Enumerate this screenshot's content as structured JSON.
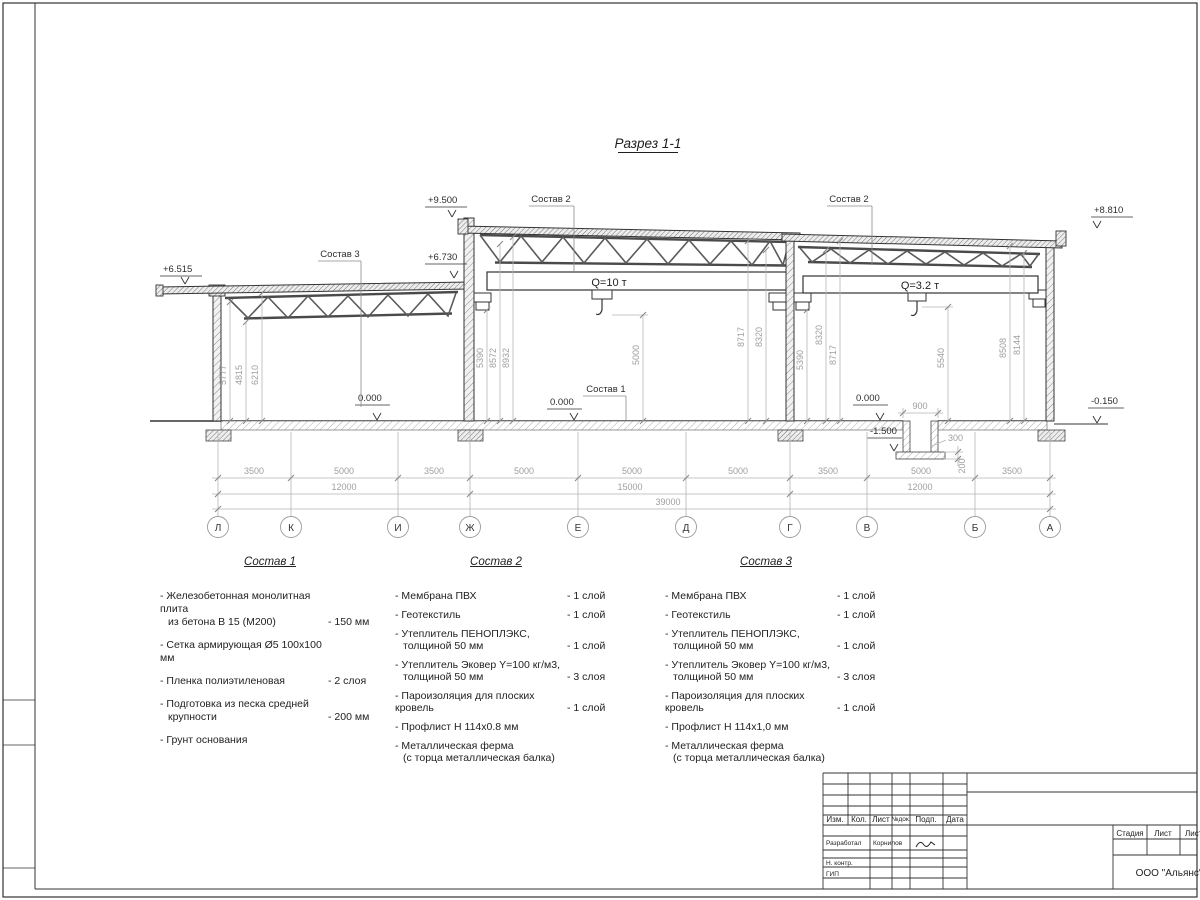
{
  "drawing": {
    "title": "Разрез 1-1",
    "levels": {
      "left_eave": "+6.515",
      "left_high": "+6.730",
      "mid_top": "+9.500",
      "right_top": "+8.810",
      "zero_left": "0.000",
      "zero_mid": "0.000",
      "zero_pit": "0.000",
      "pit_bottom": "-1.500",
      "grade_right": "-0.150"
    },
    "callouts": {
      "sostav1": "Состав 1",
      "sostav2_mid": "Состав 2",
      "sostav2_right": "Состав 2",
      "sostav3": "Состав 3"
    },
    "cranes": {
      "mid": "Q=10 т",
      "right": "Q=3.2 т"
    },
    "vdims": [
      "5777",
      "4815",
      "6210",
      "5390",
      "8572",
      "8932",
      "5000",
      "8717",
      "8320",
      "5390",
      "8320",
      "8717",
      "5540",
      "8508",
      "8144"
    ],
    "pit": {
      "width": "900",
      "wall": "300",
      "base": "200"
    },
    "dims1": [
      "3500",
      "5000",
      "3500",
      "5000",
      "5000",
      "5000",
      "3500",
      "5000",
      "3500"
    ],
    "dims2": [
      "12000",
      "15000",
      "12000"
    ],
    "total": "39000",
    "axes": [
      "Л",
      "К",
      "И",
      "Ж",
      "Е",
      "Д",
      "Г",
      "В",
      "Б",
      "А"
    ]
  },
  "legends": [
    {
      "title": "Состав 1",
      "items": [
        {
          "l1": "- Железобетонная  монолитная плита",
          "l2": "из бетона В 15 (М200)",
          "qty": "- 150 мм"
        },
        {
          "l1": "- Сетка армирующая Ø5 100х100 мм",
          "l2": "",
          "qty": ""
        },
        {
          "l1": "- Пленка полиэтиленовая",
          "l2": "",
          "qty": "-  2 слоя"
        },
        {
          "l1": "- Подготовка из песка средней",
          "l2": "крупности",
          "qty": "- 200 мм"
        },
        {
          "l1": "- Грунт основания",
          "l2": "",
          "qty": ""
        }
      ]
    },
    {
      "title": "Состав 2",
      "items": [
        {
          "l1": "- Мембрана ПВХ",
          "l2": "",
          "qty": "- 1 слой"
        },
        {
          "l1": "- Геотекстиль",
          "l2": "",
          "qty": "- 1 слой"
        },
        {
          "l1": "- Утеплитель ПЕНОПЛЭКС,",
          "l2": "толщиной 50 мм",
          "qty": "- 1 слой"
        },
        {
          "l1": "- Утеплитель Эковер Y=100 кг/м3,",
          "l2": "толщиной 50 мм",
          "qty": "- 3 слоя"
        },
        {
          "l1": "- Пароизоляция для плоских кровель",
          "l2": "",
          "qty": "- 1 слой"
        },
        {
          "l1": "- Профлист Н 114х0.8 мм",
          "l2": "",
          "qty": ""
        },
        {
          "l1": "- Металлическая ферма",
          "l2": "(с торца металлическая балка)",
          "qty": ""
        }
      ]
    },
    {
      "title": "Состав 3",
      "items": [
        {
          "l1": "- Мембрана ПВХ",
          "l2": "",
          "qty": "- 1 слой"
        },
        {
          "l1": "- Геотекстиль",
          "l2": "",
          "qty": "- 1 слой"
        },
        {
          "l1": "- Утеплитель ПЕНОПЛЭКС,",
          "l2": "толщиной 50 мм",
          "qty": "- 1 слой"
        },
        {
          "l1": "- Утеплитель Эковер Y=100 кг/м3,",
          "l2": "толщиной 50 мм",
          "qty": "- 3 слоя"
        },
        {
          "l1": "- Пароизоляция для плоских кровель",
          "l2": "",
          "qty": "- 1 слой"
        },
        {
          "l1": "- Профлист Н 114х1,0 мм",
          "l2": "",
          "qty": ""
        },
        {
          "l1": "- Металлическая ферма",
          "l2": "(с торца металлическая балка)",
          "qty": ""
        }
      ]
    }
  ],
  "titleblock": {
    "header": [
      "Изм.",
      "Кол.",
      "Лист",
      "№док.",
      "Подп.",
      "Дата"
    ],
    "developer_label": "Разработал",
    "developer_name": "Корнилов",
    "ncontr_label": "Н. контр.",
    "gip_label": "ГИП",
    "stage_cols": [
      "Стадия",
      "Лист",
      "Листов"
    ],
    "company": "ООО \"Альянс\""
  }
}
